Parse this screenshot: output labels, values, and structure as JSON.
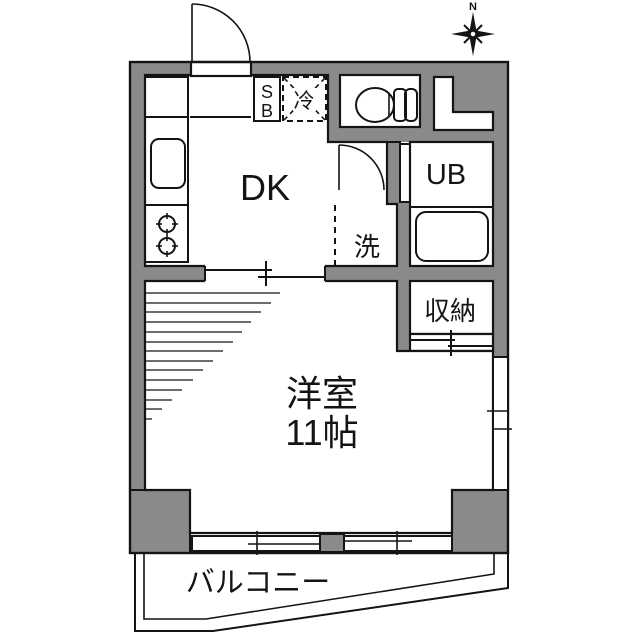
{
  "plan": {
    "north_label": "N",
    "rooms": {
      "dk_label": "DK",
      "unit_bath_label": "UB",
      "washer_label": "洗",
      "closet_label": "収納",
      "refrigerator_label": "冷",
      "shoe_box_line1": "S",
      "shoe_box_line2": "B",
      "main_room_name": "洋室",
      "main_room_size": "11帖",
      "balcony_label": "バルコニー"
    },
    "colors": {
      "wall": "#8a8a8a",
      "line": "#141414",
      "floor": "#ffffff"
    }
  }
}
